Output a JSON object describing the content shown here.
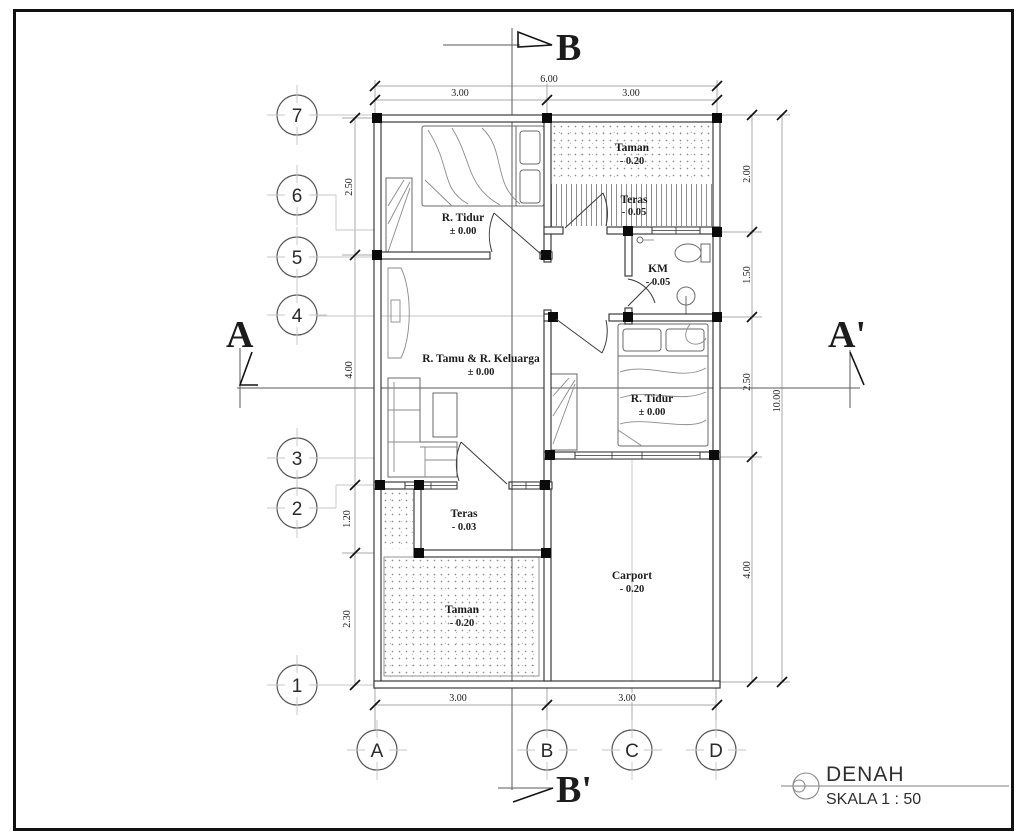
{
  "drawing": {
    "title": "DENAH",
    "scale": "SKALA 1 : 50"
  },
  "sections": {
    "top": "B",
    "bottom": "B'",
    "left": "A",
    "right": "A'"
  },
  "grid_rows": [
    "7",
    "6",
    "5",
    "4",
    "3",
    "2",
    "1"
  ],
  "grid_cols": [
    "A",
    "B",
    "C",
    "D"
  ],
  "rooms": {
    "bedroom1": {
      "name": "R. Tidur",
      "level": "± 0.00"
    },
    "taman_top": {
      "name": "Taman",
      "level": "- 0.20"
    },
    "teras_top": {
      "name": "Teras",
      "level": "- 0.05"
    },
    "km": {
      "name": "KM",
      "level": "- 0.05"
    },
    "living": {
      "name": "R. Tamu & R. Keluarga",
      "level": "± 0.00"
    },
    "bedroom2": {
      "name": "R. Tidur",
      "level": "± 0.00"
    },
    "teras_front": {
      "name": "Teras",
      "level": "- 0.03"
    },
    "taman_front": {
      "name": "Taman",
      "level": "- 0.20"
    },
    "carport": {
      "name": "Carport",
      "level": "- 0.20"
    }
  },
  "dims": {
    "top_total": "6.00",
    "top_left": "3.00",
    "top_right": "3.00",
    "bottom_left": "3.00",
    "bottom_right": "3.00",
    "left": [
      "2.50",
      "4.00",
      "1.20",
      "2.30"
    ],
    "right": [
      "2.00",
      "1.50",
      "2.50",
      "4.00"
    ],
    "right_total": "10.00"
  }
}
